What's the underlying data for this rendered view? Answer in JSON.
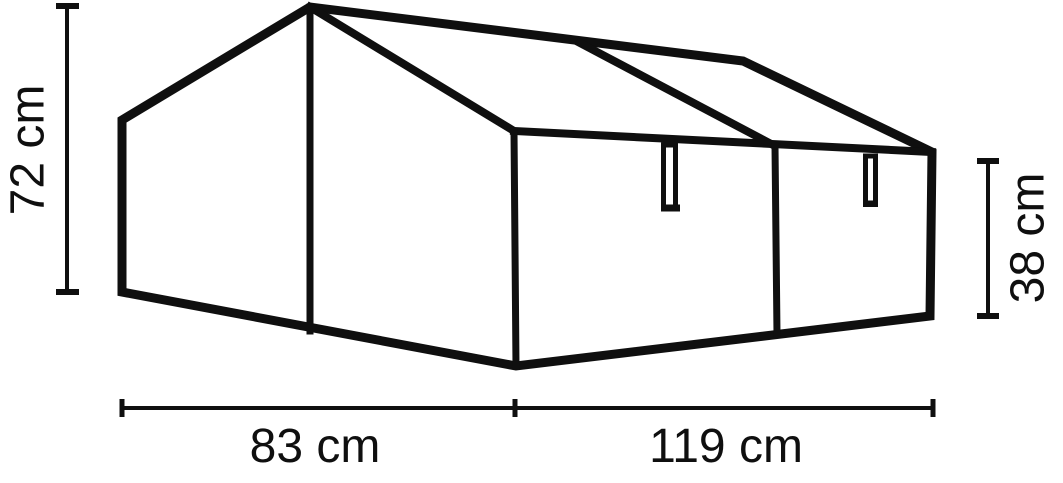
{
  "diagram": {
    "colors": {
      "line": "#0f0f0f",
      "background": "#ffffff"
    },
    "dimensions": {
      "left_height": {
        "label": "72 cm",
        "value_cm": 72
      },
      "right_height": {
        "label": "38 cm",
        "value_cm": 38
      },
      "bottom_left_width": {
        "label": "83 cm",
        "value_cm": 83
      },
      "bottom_right_width": {
        "label": "119 cm",
        "value_cm": 119
      }
    }
  }
}
